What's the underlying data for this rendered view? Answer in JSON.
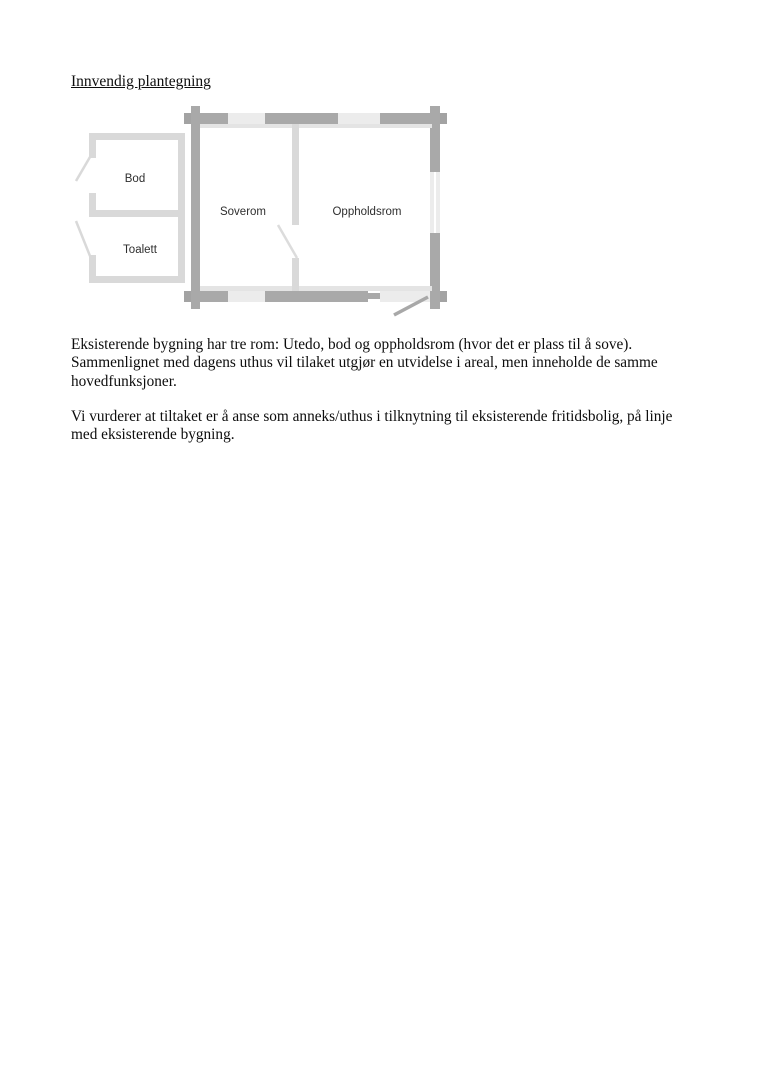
{
  "heading": {
    "text": "Innvendig plantegning"
  },
  "floorplan": {
    "rooms": [
      {
        "name": "bod",
        "label": "Bod"
      },
      {
        "name": "toalett",
        "label": "Toalett"
      },
      {
        "name": "soverom",
        "label": "Soverom"
      },
      {
        "name": "oppholdsrom",
        "label": "Oppholdsrom"
      }
    ],
    "colors": {
      "wall_main": "#a9a9a9",
      "wall_light_segment": "#ececec",
      "wall_annex": "#d9d9d9",
      "inner_wall_line": "#e4e4e4",
      "window_glass": "#ffffff"
    }
  },
  "paragraphs": {
    "p1": {
      "lines": [
        "Eksisterende bygning har tre rom: Utedo, bod og oppholdsrom (hvor det er plass til å sove).",
        "Sammenlignet med dagens uthus vil tilaket utgjør en utvidelse i areal, men inneholde de samme",
        "hovedfunksjoner."
      ]
    },
    "p2": {
      "lines": [
        "Vi vurderer at tiltaket er å anse som anneks/uthus i tilknytning til eksisterende fritidsbolig, på linje",
        "med eksisterende bygning."
      ]
    }
  }
}
